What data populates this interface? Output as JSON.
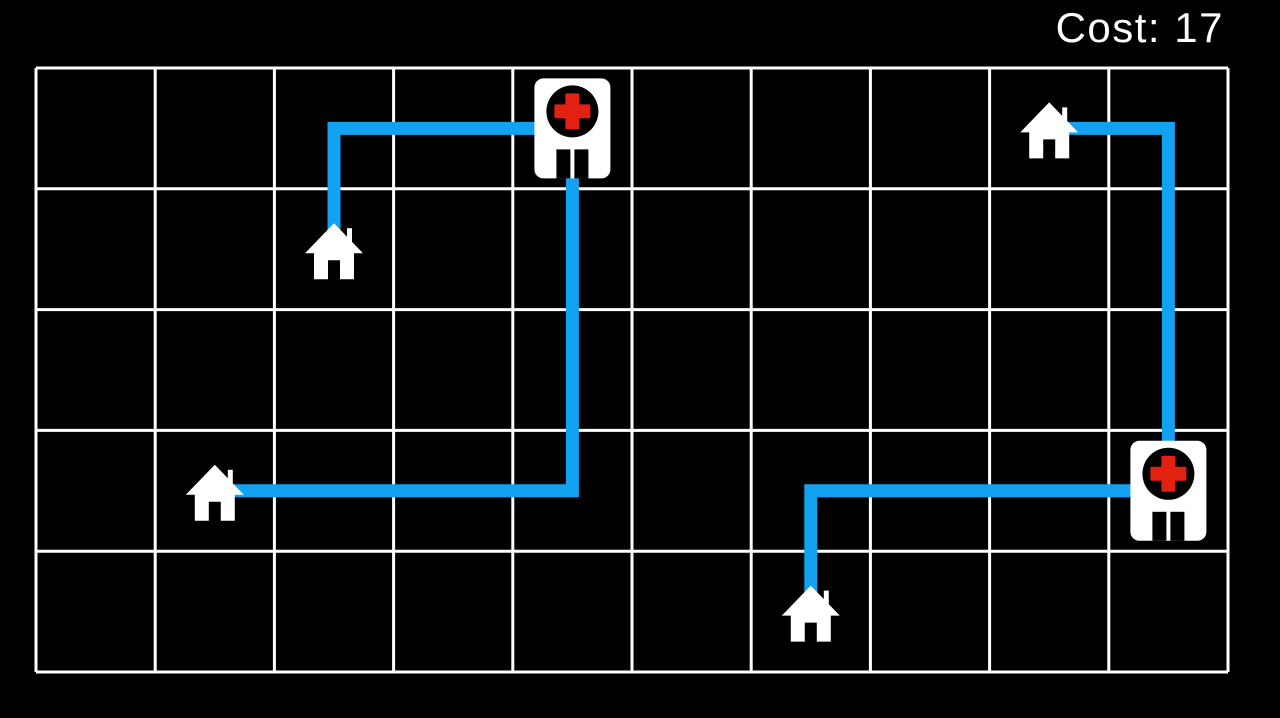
{
  "hud": {
    "cost_label": "Cost: 17",
    "cost_value": 17
  },
  "board": {
    "cols": 10,
    "rows": 5,
    "grid_color": "#ffffff",
    "grid_line_width": 3,
    "background": "#000000",
    "path_color": "#13a1f2",
    "path_width": 13
  },
  "colors": {
    "icon_white": "#ffffff",
    "icon_black": "#000000",
    "cross_red": "#e22112"
  },
  "entities": {
    "hospitals": [
      {
        "id": "hospital-1",
        "col": 4,
        "row": 0
      },
      {
        "id": "hospital-2",
        "col": 9,
        "row": 3
      }
    ],
    "houses": [
      {
        "id": "house-1",
        "col": 8,
        "row": 0
      },
      {
        "id": "house-2",
        "col": 2,
        "row": 1
      },
      {
        "id": "house-3",
        "col": 1,
        "row": 3
      },
      {
        "id": "house-4",
        "col": 6,
        "row": 4
      }
    ]
  },
  "paths": [
    {
      "from": "house-2",
      "to": "hospital-1",
      "moves": 3,
      "cells": [
        [
          2,
          1
        ],
        [
          2,
          0
        ],
        [
          3,
          0
        ],
        [
          4,
          0
        ]
      ]
    },
    {
      "from": "house-3",
      "to": "hospital-1",
      "moves": 6,
      "cells": [
        [
          1,
          3
        ],
        [
          2,
          3
        ],
        [
          3,
          3
        ],
        [
          4,
          3
        ],
        [
          4,
          2
        ],
        [
          4,
          1
        ],
        [
          4,
          0
        ]
      ]
    },
    {
      "from": "house-1",
      "to": "hospital-2",
      "moves": 4,
      "cells": [
        [
          8,
          0
        ],
        [
          9,
          0
        ],
        [
          9,
          1
        ],
        [
          9,
          2
        ],
        [
          9,
          3
        ]
      ]
    },
    {
      "from": "house-4",
      "to": "hospital-2",
      "moves": 4,
      "cells": [
        [
          6,
          4
        ],
        [
          6,
          3
        ],
        [
          7,
          3
        ],
        [
          8,
          3
        ],
        [
          9,
          3
        ]
      ]
    }
  ]
}
